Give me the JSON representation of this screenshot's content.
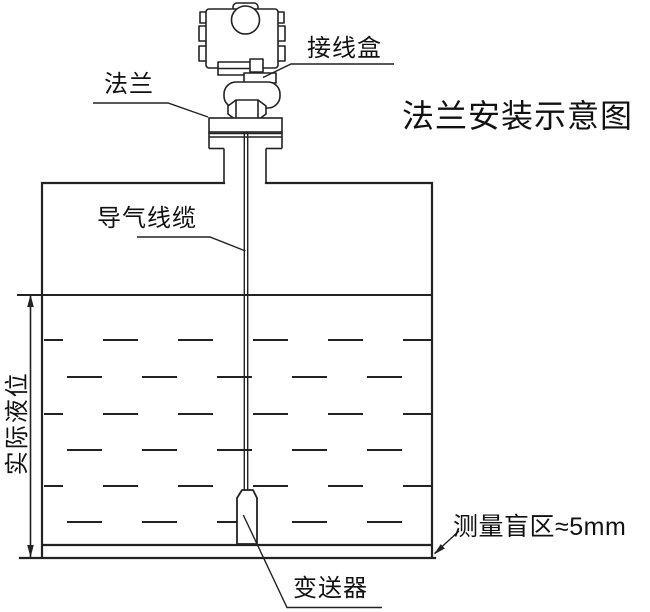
{
  "title": "法兰安装示意图",
  "labels": {
    "junction_box": "接线盒",
    "flange": "法兰",
    "air_guide_cable": "导气线缆",
    "actual_liquid_level": "实际液位",
    "blind_zone": "测量盲区≈5mm",
    "transmitter_probe": "变送器"
  },
  "colors": {
    "line": "#222222",
    "text": "#111111",
    "background": "#ffffff"
  }
}
